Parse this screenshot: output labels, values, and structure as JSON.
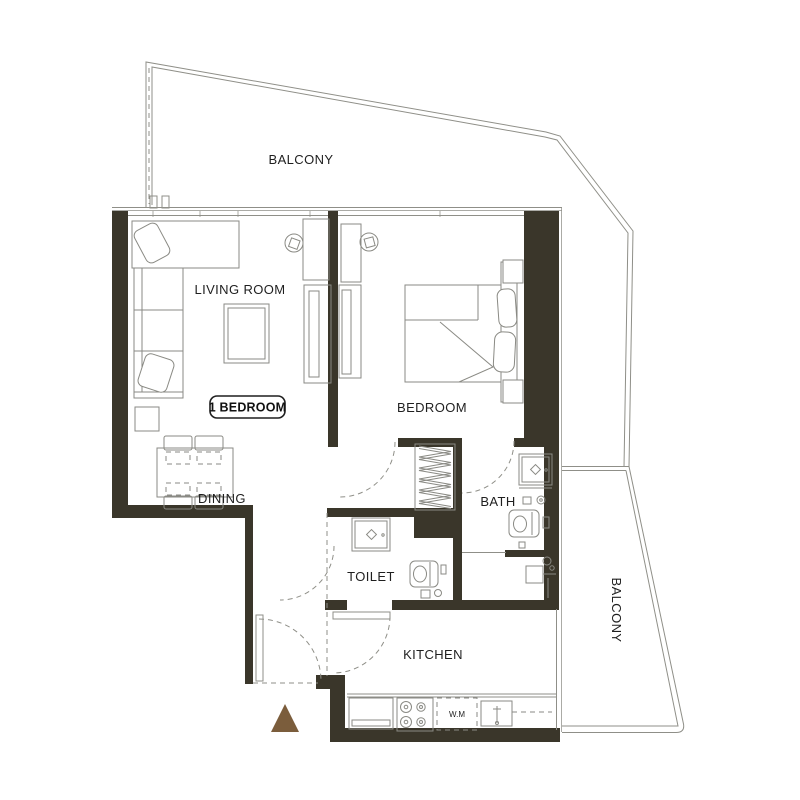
{
  "plan": {
    "unit_badge": "1 BEDROOM",
    "colors": {
      "wall-color": "#3a362a",
      "line-color": "#8f8f88",
      "furniture-color": "#8a8a84",
      "text-color": "#1f1f1f",
      "entrance-marker-color": "#7b5d3c"
    },
    "rooms": {
      "balcony_top": {
        "label": "BALCONY"
      },
      "balcony_right": {
        "label": "BALCONY"
      },
      "living_room": {
        "label": "LIVING ROOM"
      },
      "bedroom": {
        "label": "BEDROOM"
      },
      "dining": {
        "label": "DINING"
      },
      "bath": {
        "label": "BATH"
      },
      "toilet": {
        "label": "TOILET"
      },
      "kitchen": {
        "label": "KITCHEN"
      }
    },
    "appliances": {
      "washing_machine": "W.M"
    }
  }
}
